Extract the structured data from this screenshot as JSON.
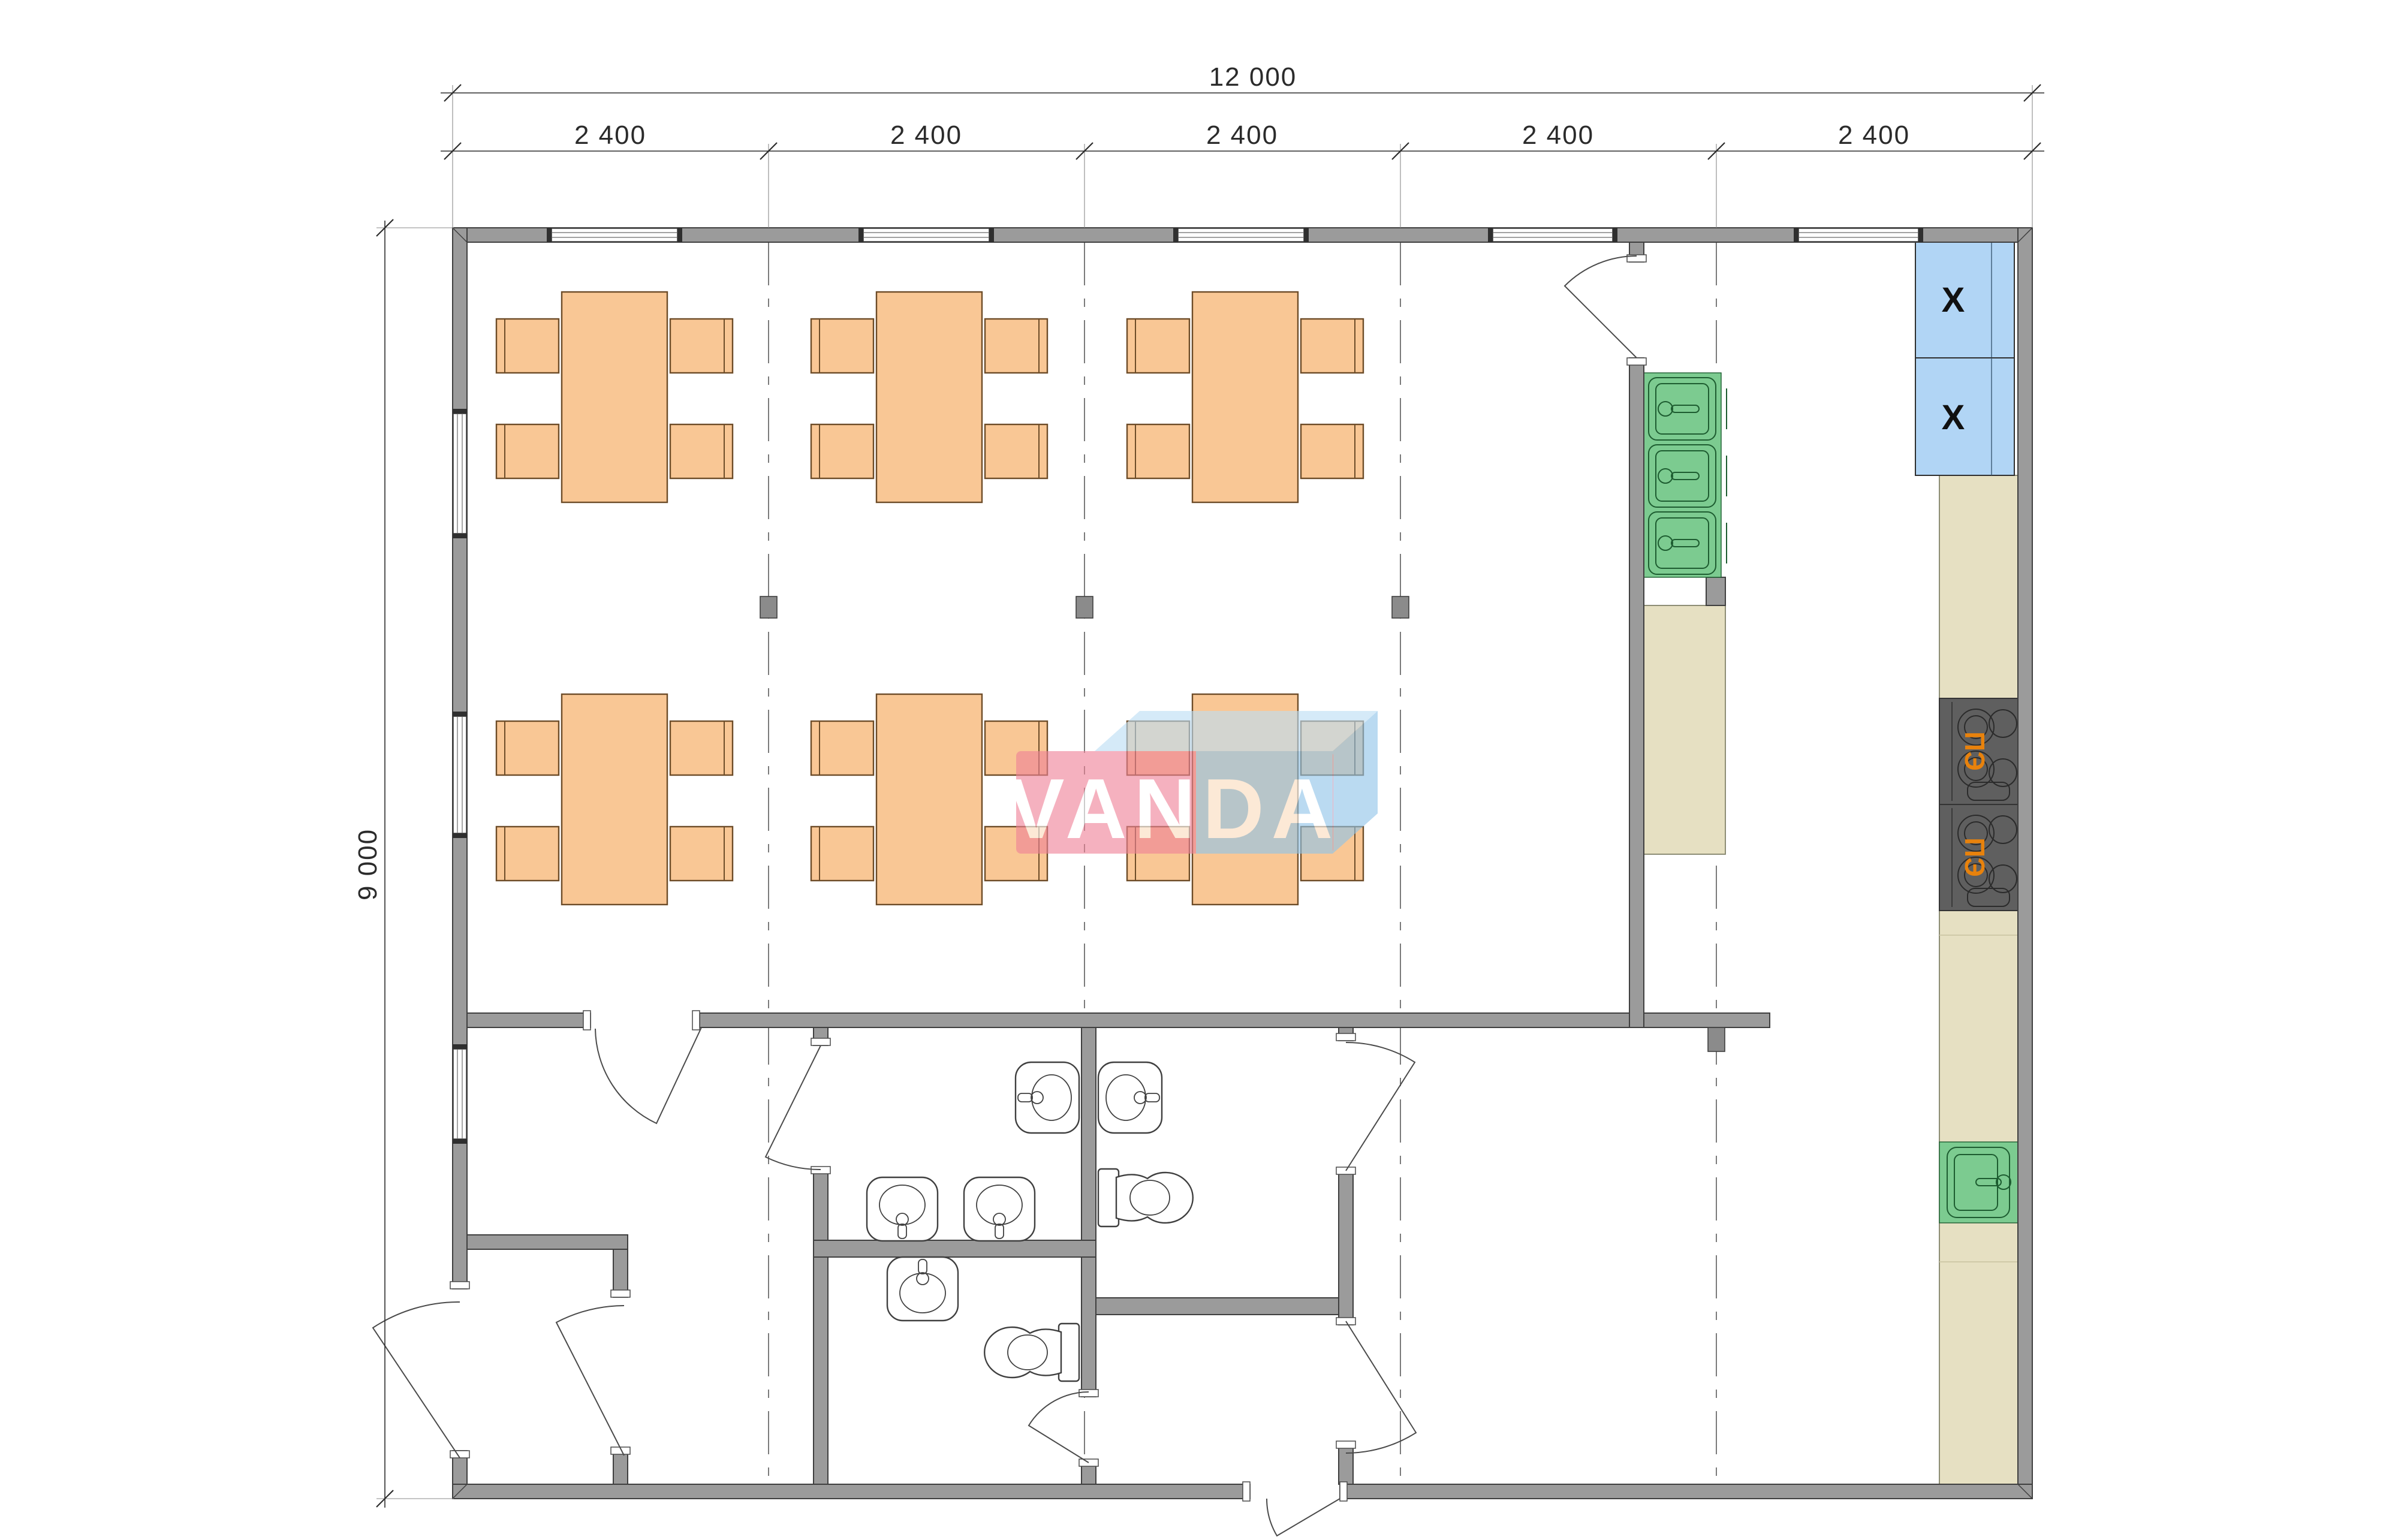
{
  "sheet": {
    "background": "#ffffff"
  },
  "dimensions": {
    "overall_width_label": "12 000",
    "module_label": "2 400",
    "module_count": 5,
    "overall_height_label": "9 000"
  },
  "watermark": {
    "text": "VANDA"
  },
  "appliances": {
    "stove_label": "ПЭ",
    "stove_count": 2,
    "fridge_mark": "X",
    "fridge_count": 2,
    "kitchen_sink_basins": 3,
    "counter_sink_basins": 1
  },
  "furniture": {
    "dining_tables": 6,
    "chairs_per_table": 4
  },
  "fixtures": {
    "wall_basins": 5,
    "toilets": 2
  },
  "colors": {
    "page_bg": "#ffffff",
    "wall_fill": "#9b9b9b",
    "wall_stroke": "#3f3f3f",
    "counter_fill": "#e6e0c2",
    "counter_stroke": "#82826a",
    "sink_fill": "#7ccb90",
    "sink_stroke": "#1d5c30",
    "fridge_fill": "#b1d5f5",
    "fridge_stroke": "#2f2f2f",
    "fridge_mark_color": "#111111",
    "stove_fill": "#5f5f5f",
    "stove_stroke": "#343434",
    "stove_label_color": "#e8820c",
    "table_fill": "#f9c795",
    "table_stroke": "#6d4c28",
    "fixture_stroke": "#3f3f3f",
    "dash_color": "#5a5a5a",
    "dim_color": "#2b2b2b",
    "door_stroke": "#4a4a4a",
    "wm_pink": "#ef8398",
    "wm_blue_top": "#bcdef5",
    "wm_blue_front": "#90c4e9",
    "wm_text": "#ffffff",
    "wm_opacity": "0.62"
  }
}
